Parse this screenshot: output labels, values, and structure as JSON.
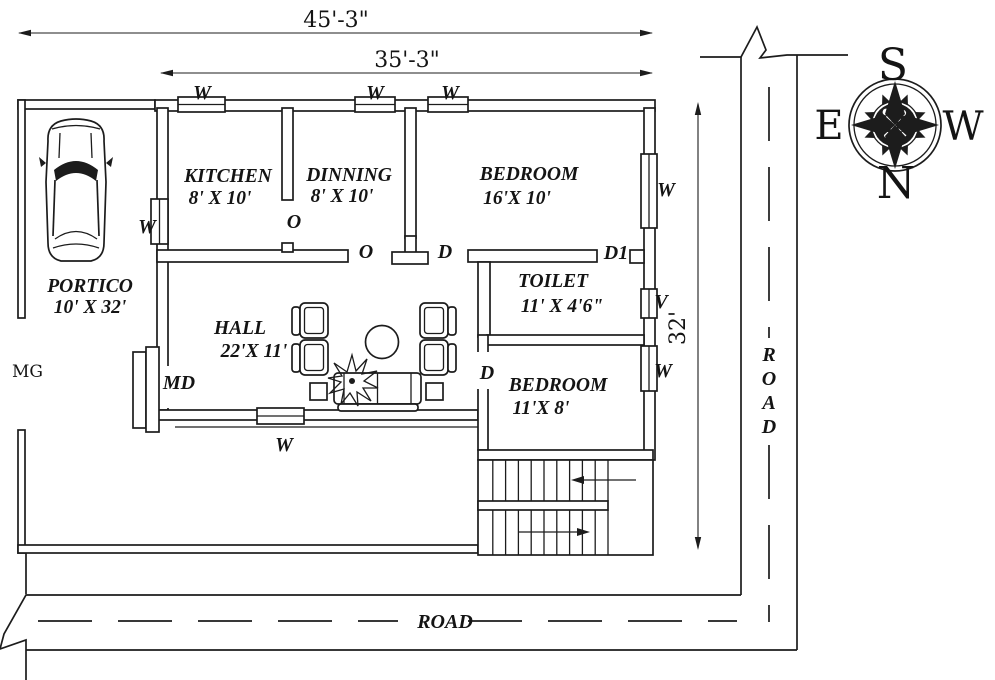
{
  "drawing": {
    "dims": {
      "overall_width": "45'-3\"",
      "inner_width": "35'-3\"",
      "side_height": "32'"
    },
    "rooms": {
      "kitchen": {
        "name": "KITCHEN",
        "size": "8' X 10'"
      },
      "dinning": {
        "name": "DINNING",
        "size": "8' X 10'"
      },
      "bedroom1": {
        "name": "BEDROOM",
        "size": "16'X 10'"
      },
      "toilet": {
        "name": "TOILET",
        "size": "11' X 4'6\""
      },
      "hall": {
        "name": "HALL",
        "size": "22'X 11'"
      },
      "bedroom2": {
        "name": "BEDROOM",
        "size": "11'X 8'"
      },
      "portico": {
        "name": "PORTICO",
        "size": "10' X 32'"
      }
    },
    "markers": {
      "window": "W",
      "opening": "O",
      "door": "D",
      "door1": "D1",
      "ventilator": "V",
      "main_door": "MD",
      "main_gate": "MG"
    },
    "compass": {
      "top": "S",
      "left": "E",
      "right": "W",
      "bottom": "N"
    },
    "roads": {
      "bottom": "ROAD",
      "right_letters": [
        "R",
        "O",
        "A",
        "D"
      ]
    },
    "colors": {
      "ink": "#1c1c1c",
      "paper": "#ffffff"
    }
  }
}
